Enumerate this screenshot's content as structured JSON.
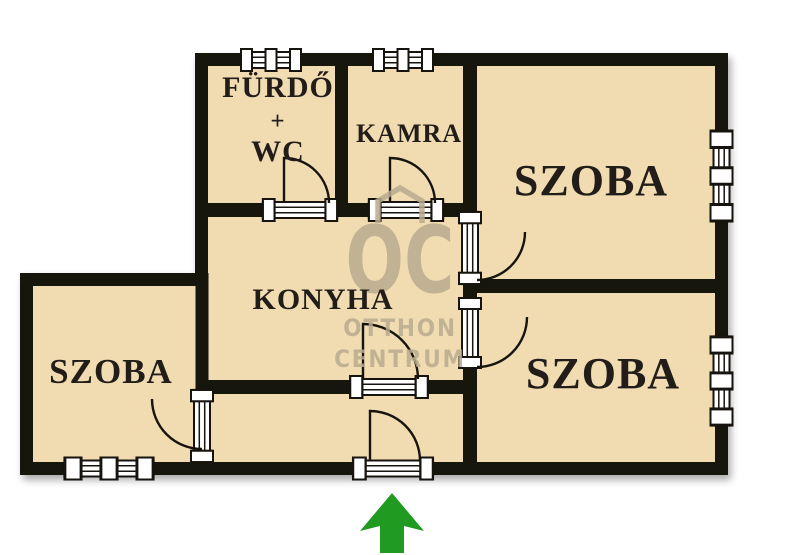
{
  "floorplan": {
    "background_color": "#ffffff",
    "room_fill_color": "#f1dcb2",
    "wall_color": "#17130f",
    "label_color": "#221d19",
    "labels": {
      "bathroom_line1": "FÜRDŐ",
      "bathroom_line2": "+",
      "bathroom_line3": "WC",
      "pantry": "KAMRA",
      "room_top_right": "SZOBA",
      "kitchen": "KONYHA",
      "room_bottom_left": "SZOBA",
      "room_bottom_right": "SZOBA"
    },
    "window_count": 5,
    "door_count": 7,
    "entrance_arrow": {
      "color": "#219a21",
      "direction": "up"
    }
  },
  "watermark": {
    "logo": "OC",
    "line1": "OTTHON",
    "line2": "CENTRUM",
    "color": "#b8ab8e"
  }
}
